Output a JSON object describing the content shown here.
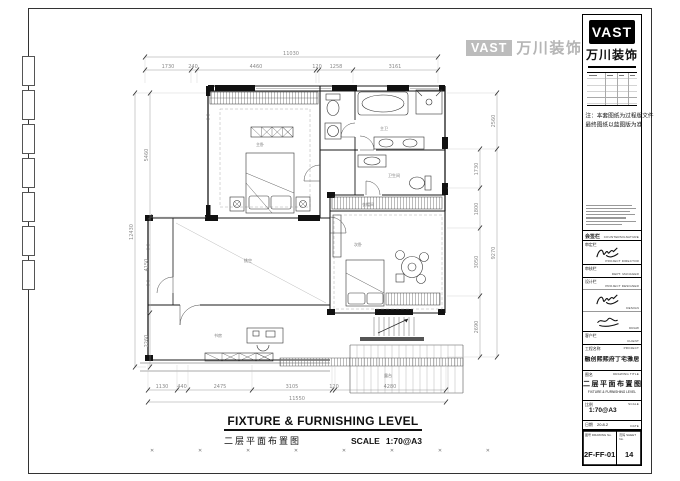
{
  "watermark": {
    "logo": "VAST",
    "brand": "万川装饰"
  },
  "caption": {
    "title_en": "FIXTURE & FURNISHING LEVEL",
    "title_cn": "二层平面布置图",
    "scale_label": "SCALE",
    "scale_value": "1:70@A3"
  },
  "plan": {
    "rooms": [
      {
        "label": "主卧"
      },
      {
        "label": "主卫"
      },
      {
        "label": "卫生间"
      },
      {
        "label": "衣帽间"
      },
      {
        "label": "次卧"
      },
      {
        "label": "书房"
      },
      {
        "label": "挑空"
      },
      {
        "label": "露台"
      }
    ],
    "dims": {
      "top": {
        "overall": "11030",
        "segments": [
          "1730",
          "240",
          "4460",
          "120",
          "1258",
          "3161"
        ]
      },
      "bottom": {
        "overall": "11550",
        "segments": [
          "1130",
          "440",
          "2475",
          "3105",
          "120",
          "4280"
        ]
      },
      "left": {
        "overall": "12430",
        "segments": [
          "5460",
          "4150",
          "2260"
        ]
      },
      "right_outer": {
        "segments": [
          "2560",
          "9270"
        ]
      },
      "right_inner": {
        "segments": [
          "1730",
          "1800",
          "3050",
          "2690"
        ]
      }
    }
  },
  "title_block": {
    "logo": "VAST",
    "brand": "万川装饰",
    "note1": "注：本套图纸为过程版文件",
    "note2": "最终图纸以蓝图版为准",
    "countersign_cn": "会签栏",
    "countersign_en": "COUNTERSIGNATURE",
    "sign_rows": [
      {
        "cn": "审定栏",
        "en": "PROJECT DIRECTOR"
      },
      {
        "cn": "审核栏",
        "en": "DEPT. MANAGER"
      },
      {
        "cn": "设计栏",
        "en": "PROJECT DESIGNER"
      },
      {
        "cn": "",
        "en": "DESIGN"
      },
      {
        "cn": "",
        "en": "DRAW"
      },
      {
        "cn": "客户栏",
        "en": "CLIENT"
      }
    ],
    "project": {
      "label_cn": "工程名称",
      "label_en": "PROJECT",
      "value": "融创熙熙府丁宅雅居"
    },
    "drawing_title": {
      "label_cn": "图名",
      "label_en": "DRAWING TITLE",
      "value_cn": "二层平面布置图",
      "value_en": "FIXTURE & FURNISHING LEVEL"
    },
    "scale": {
      "label_cn": "比例",
      "label_en": "SCALE",
      "value": "1:70@A3"
    },
    "date": {
      "label_cn": "日期",
      "label_en": "DATE",
      "value": "20.8.2"
    },
    "drawing_no": {
      "label_cn": "图号",
      "label_en": "DRAWING No.",
      "value": "2F-FF-01"
    },
    "sheet_no": {
      "label_cn": "页码",
      "label_en": "SHEET No.",
      "value": "14"
    }
  }
}
